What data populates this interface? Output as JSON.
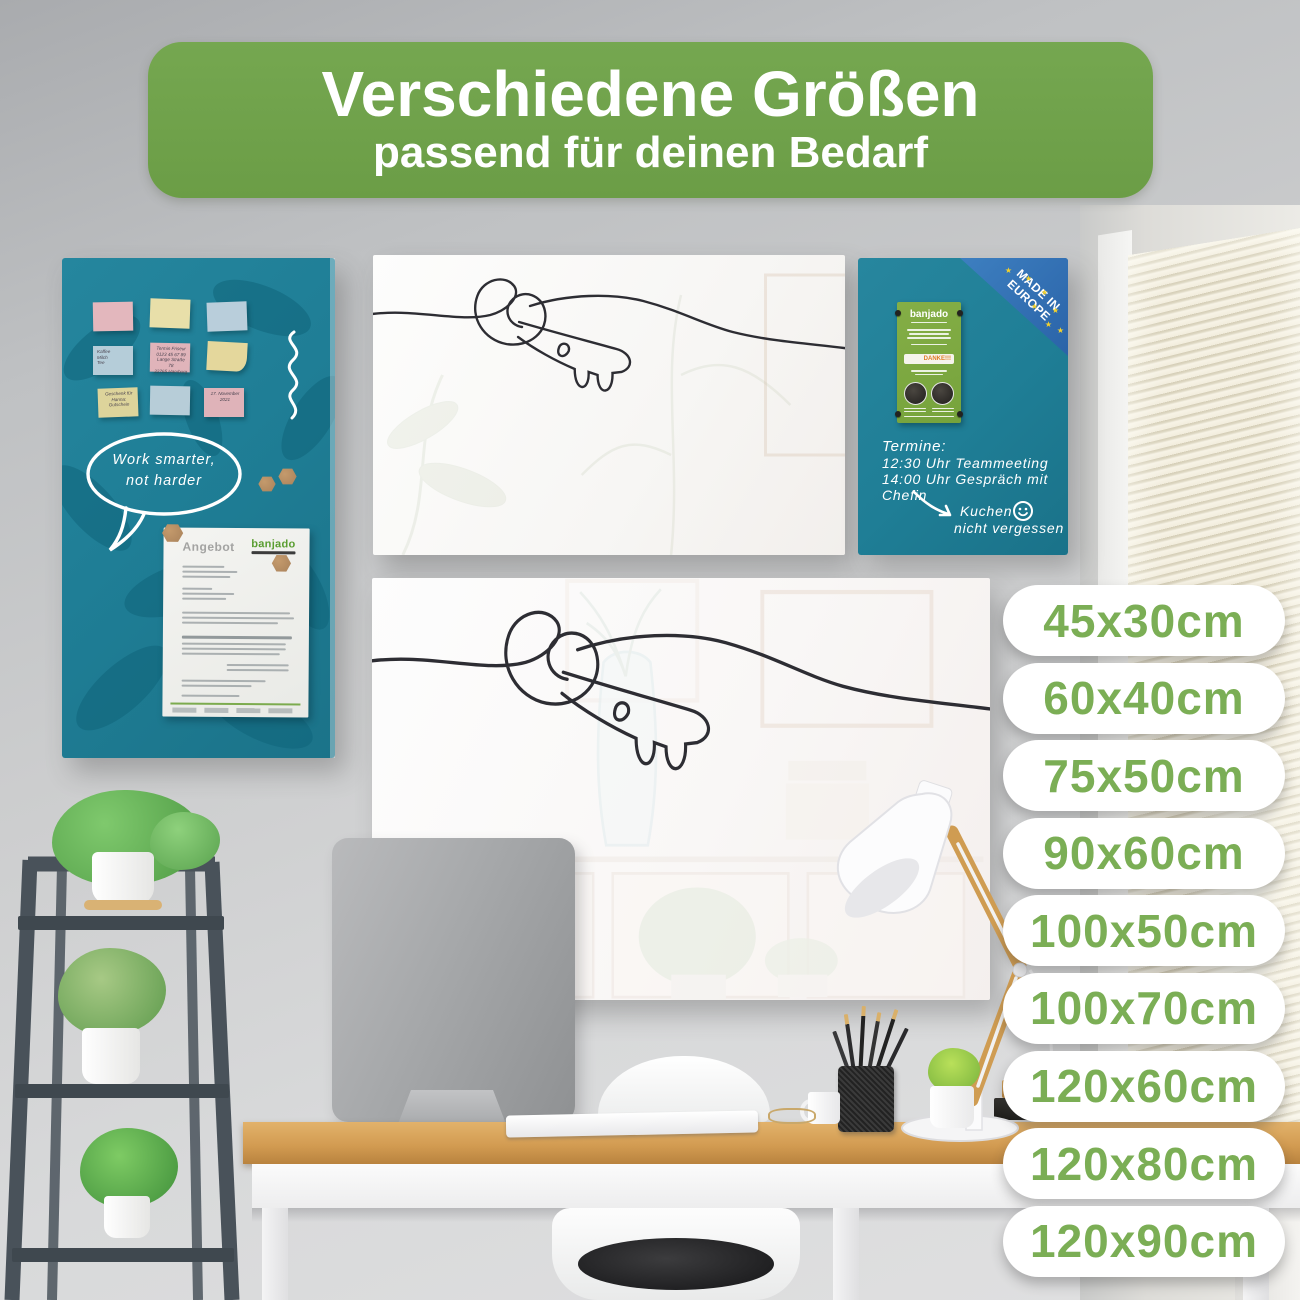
{
  "banner": {
    "title": "Verschiedene Größen",
    "subtitle": "passend für deinen Bedarf",
    "bg_color": "#6fa24a",
    "text_color": "#ffffff"
  },
  "sizes": {
    "pill_bg": "#ffffff",
    "text_color": "#7bae55",
    "items": [
      "45x30cm",
      "60x40cm",
      "75x50cm",
      "90x60cm",
      "100x50cm",
      "100x70cm",
      "120x60cm",
      "120x80cm",
      "120x90cm"
    ]
  },
  "teal_board": {
    "color": "#1f7e96",
    "speech_bubble": {
      "line1": "Work smarter,",
      "line2": "not harder"
    },
    "sticky_notes": [
      {
        "color": "#e3b7bd",
        "text": ""
      },
      {
        "color": "#e8dfa9",
        "text": ""
      },
      {
        "color": "#b9cedb",
        "text": ""
      },
      {
        "color": "#b5cdd9",
        "text": "Kaffee\nMilch\nTee"
      },
      {
        "color": "#e0b4ba",
        "text": "Termin Friseur\n0123 45 67 89\nLange Straße 78\n22765 Hamburg"
      },
      {
        "color": "#e4d79c",
        "text": ""
      },
      {
        "color": "#ddd49b",
        "text": "Geschenk für\nHanna:\nGutschein"
      },
      {
        "color": "#b7cdd8",
        "text": ""
      },
      {
        "color": "#dfb3b9",
        "text": "17. November\n2021"
      }
    ],
    "document": {
      "title": "Angebot",
      "brand": "banjado"
    }
  },
  "small_board": {
    "color": "#1f7e96",
    "ribbon": {
      "line1": "MADE IN",
      "line2": "EUROPE",
      "bg_color": "#2f6fb3",
      "star_color": "#f4d22c"
    },
    "flyer": {
      "brand": "banjado",
      "stamp": "DANKE!!!",
      "bg_color": "#7aa83f"
    },
    "handwriting": {
      "line1": "Termine:",
      "line2": "12:30 Uhr Teammeeting",
      "line3": "14:00 Uhr Gespräch mit Chefin",
      "line4": "Kuchen",
      "line5": "nicht vergessen"
    }
  }
}
